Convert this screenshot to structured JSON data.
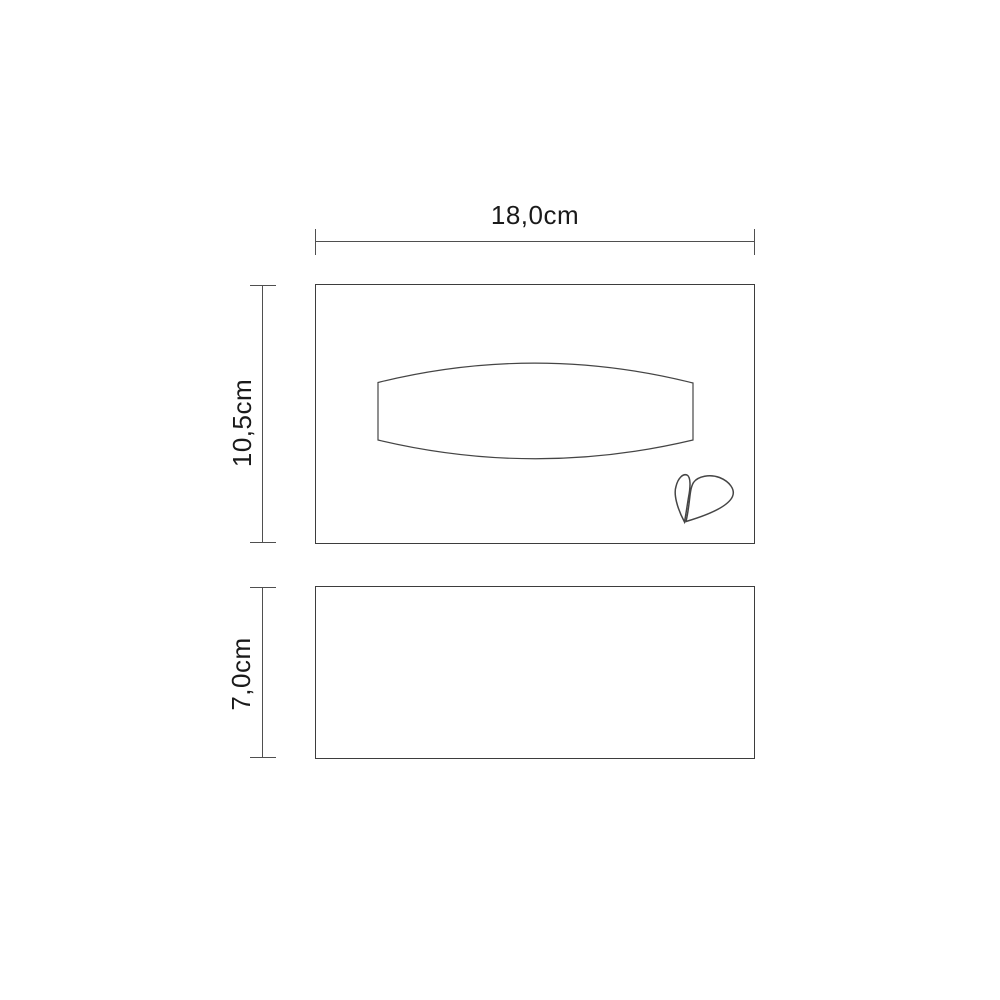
{
  "page": {
    "background_color": "#ffffff",
    "line_color": "#4f4f4f",
    "outline_color": "#3d3d3d",
    "text_color": "#1a1a1a"
  },
  "diagram": {
    "front_view": {
      "width_label": "18,0cm",
      "height_label": "10,5cm",
      "opening_icon": "tissue-opening-outline",
      "logo_icon": "leaf-drop-logo"
    },
    "side_view": {
      "height_label": "7,0cm"
    }
  }
}
